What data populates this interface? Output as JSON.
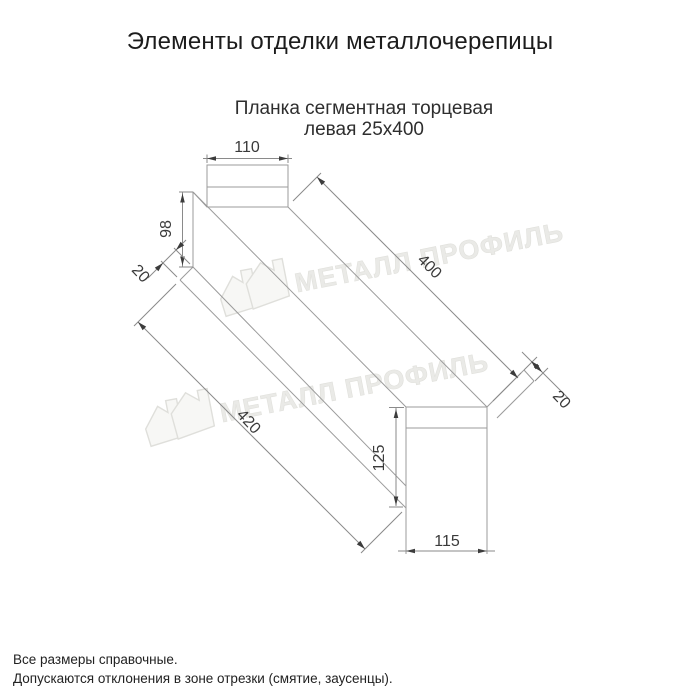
{
  "title": "Элементы отделки металлочерепицы",
  "subtitle": {
    "line1": "Планка сегментная торцевая",
    "line2": "левая 25х400"
  },
  "drawing": {
    "type": "technical-drawing",
    "part": "Планка сегментная торцевая левая 25х400",
    "dims": {
      "top_flange_width": "110",
      "left_height": "98",
      "left_lip": "20",
      "length_top": "400",
      "length_bottom": "420",
      "right_height": "125",
      "right_width": "115",
      "right_lip": "20"
    }
  },
  "watermark": {
    "text": "МЕТАЛЛ ПРОФИЛЬ"
  },
  "notes": [
    "Все размеры справочные.",
    "Допускаются отклонения в зоне отрезки (смятие, заусенцы)."
  ],
  "colors": {
    "background": "#ffffff",
    "edge_line": "#9b9b9b",
    "dim_line": "#8a8a8a",
    "text": "#2e2e2e",
    "watermark": "#d7d7d0"
  }
}
